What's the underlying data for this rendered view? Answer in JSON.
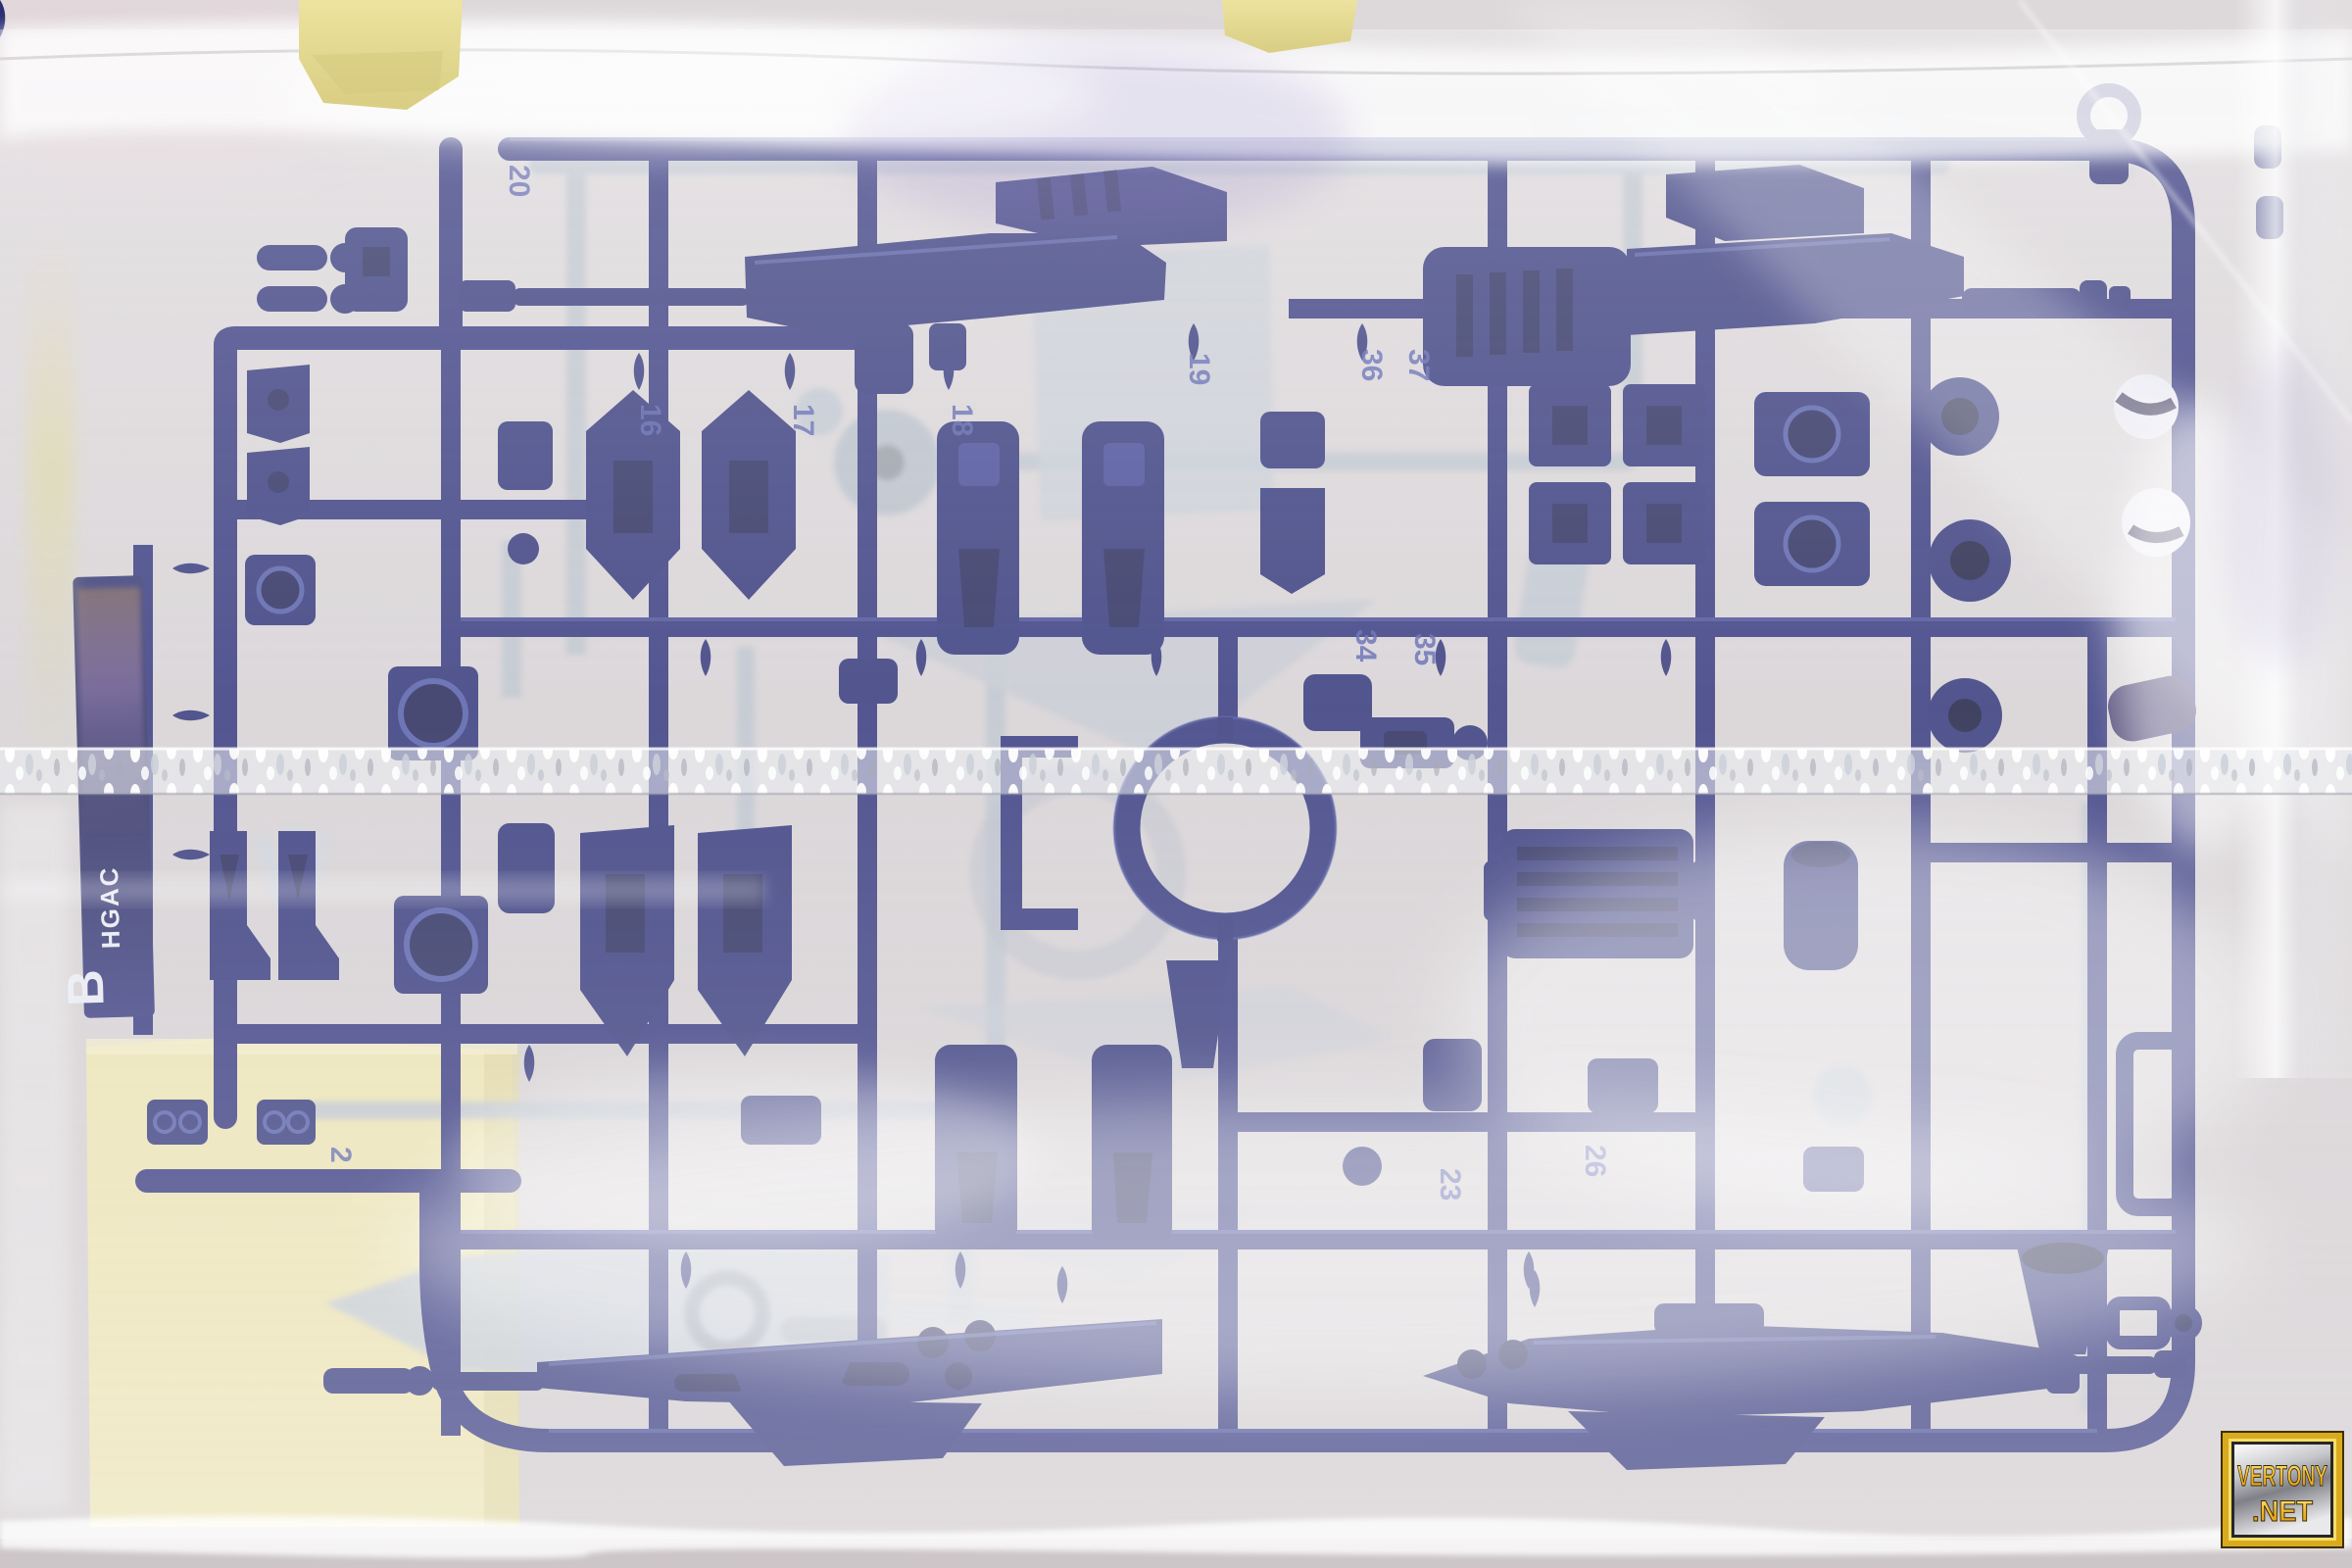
{
  "labels": {
    "runner_letter": "B",
    "runner_series": "HGAC"
  },
  "gate_numbers": [
    "20",
    "16",
    "17",
    "18",
    "19",
    "36",
    "37",
    "34",
    "35",
    "2",
    "26",
    "23"
  ],
  "watermark": {
    "line1": "VERTONY",
    "line2": ".NET"
  },
  "colors": {
    "background": "#d8d3d4",
    "plastic_navy": "#2d3180",
    "plastic_navy_dark": "#1d2054",
    "plastic_navy_light": "#4d57a6",
    "plastic_gray": "#bcc3cc",
    "bag_highlight": "#f8f7f6",
    "tape_yellow": "#e8df9f",
    "paper_cream": "#ece4b4",
    "watermark_gold": "#f2c23c"
  }
}
